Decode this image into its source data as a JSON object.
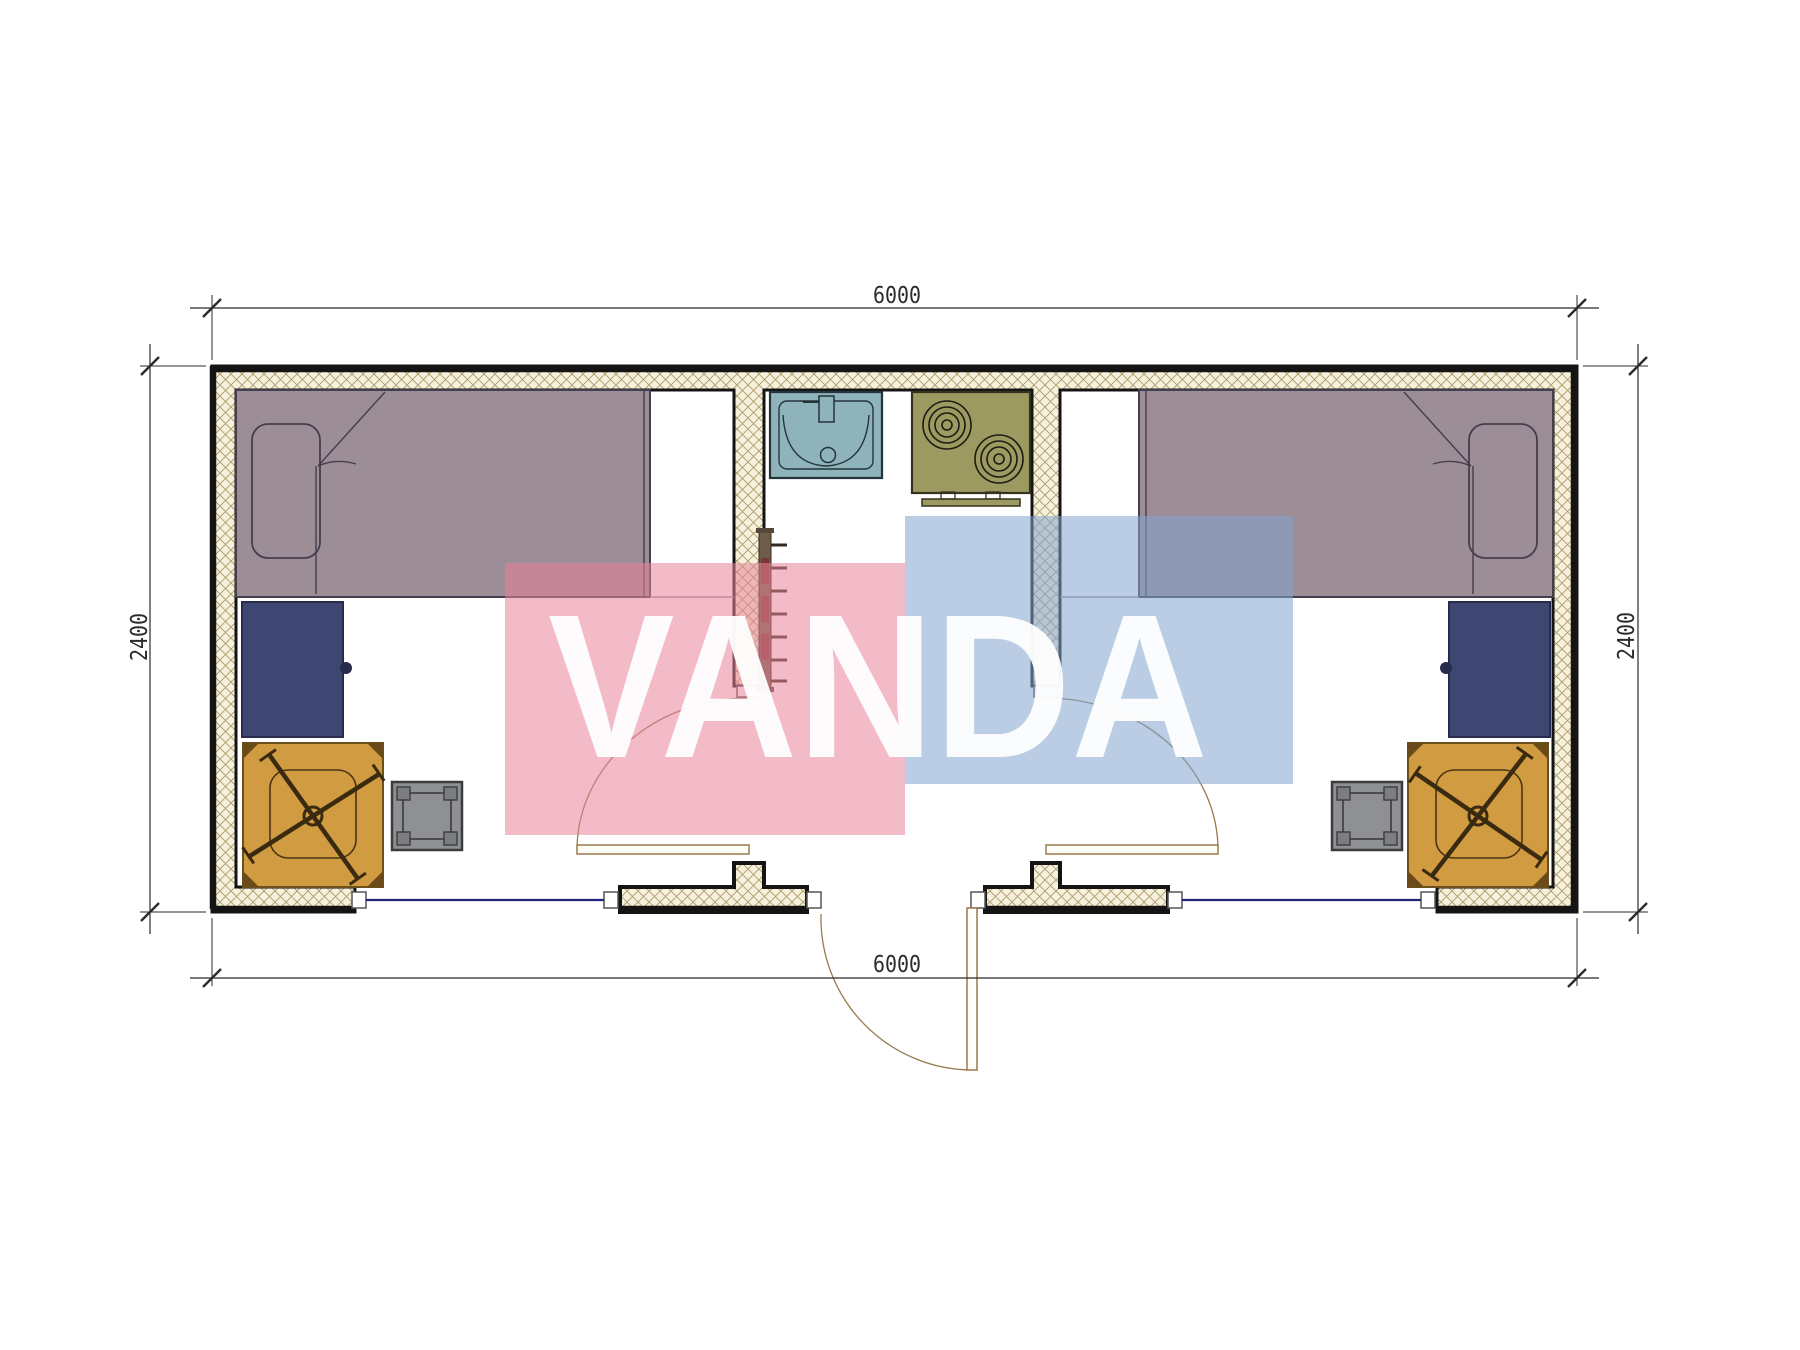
{
  "drawing": {
    "type": "floor-plan",
    "unit_hint": "mm"
  },
  "dimensions": {
    "top": "6000",
    "bottom": "6000",
    "left": "2400",
    "right": "2400"
  },
  "watermark": {
    "text": "VANDA",
    "pink": "rgba(231,131,153,0.55)",
    "blue": "rgba(129,164,206,0.55)",
    "text_color": "#ffffff"
  },
  "palette": {
    "wall_hatch_bg": "#f6f0dc",
    "wall_hatch_line": "#ab9d6a",
    "wall_line": "#141414",
    "bed": "#9c8d97",
    "bed_line": "#453e4e",
    "desk": "#3e4672",
    "desk_line": "#272c4d",
    "chair": "#d09b41",
    "chair_line": "#6b4f1d",
    "stool": "#8f9093",
    "stool_line": "#3b3c3f",
    "stool_leg": "#7c7d80",
    "sink": "#8fb3ba",
    "sink_line": "#24343a",
    "stove": "#9c9a60",
    "stove_line": "#33331f",
    "radiator": "#6f5d4b",
    "radiator_accent": "#7d3535",
    "window_line": "#23237a",
    "door_line": "#9a7a4e",
    "dim_line": "#2b2b2b",
    "frame_fill": "#ffffff"
  }
}
